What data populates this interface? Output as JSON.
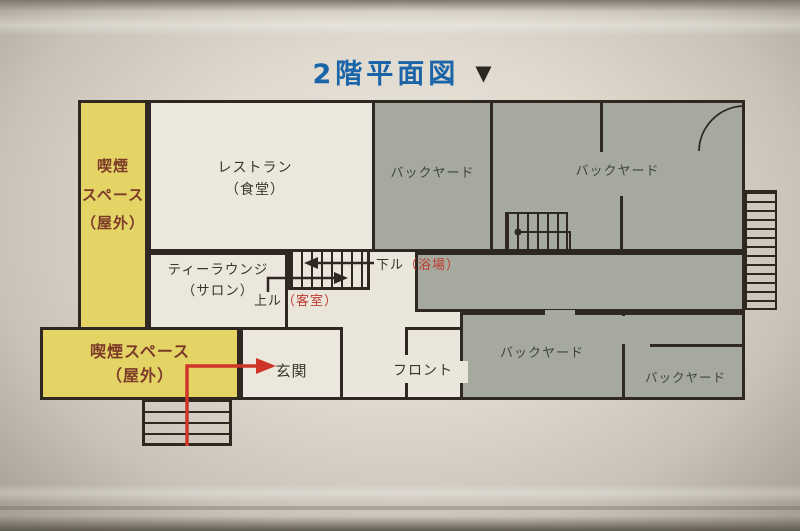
{
  "title": {
    "text": "2階平面図",
    "arrow_icon": "▼"
  },
  "floorplan": {
    "rooms": {
      "smoking_left": {
        "lines": [
          "喫煙",
          "スペース",
          "（屋外）"
        ]
      },
      "smoking_bottom": {
        "lines": [
          "喫煙スペース",
          "（屋外）"
        ]
      },
      "restaurant": {
        "lines": [
          "レストラン",
          "（食堂）"
        ]
      },
      "tea_lounge": {
        "lines": [
          "ティーラウンジ",
          "（サロン）"
        ]
      },
      "backyard_top_left": {
        "label": "バックヤード"
      },
      "backyard_top_right": {
        "label": "バックヤード"
      },
      "backyard_bottom_left": {
        "label": "バックヤード"
      },
      "backyard_bottom_right": {
        "label": "バックヤード"
      },
      "entrance": {
        "label": "玄関"
      },
      "front_desk": {
        "label": "フロント"
      }
    },
    "stairs": {
      "down": {
        "label": "下ル",
        "destination": "（浴場）"
      },
      "up": {
        "label": "上ル",
        "destination": "（客室）"
      }
    },
    "colors": {
      "title_blue": "#1a64a8",
      "wall": "#2f2822",
      "smoking_yellow": "#e4d466",
      "backyard_gray": "#a6a99e",
      "paper": "#ebe6dc",
      "route_red": "#cf3428",
      "smoking_label_brown": "#7c3a28",
      "stairs_dest_red": "#c03a30"
    }
  }
}
